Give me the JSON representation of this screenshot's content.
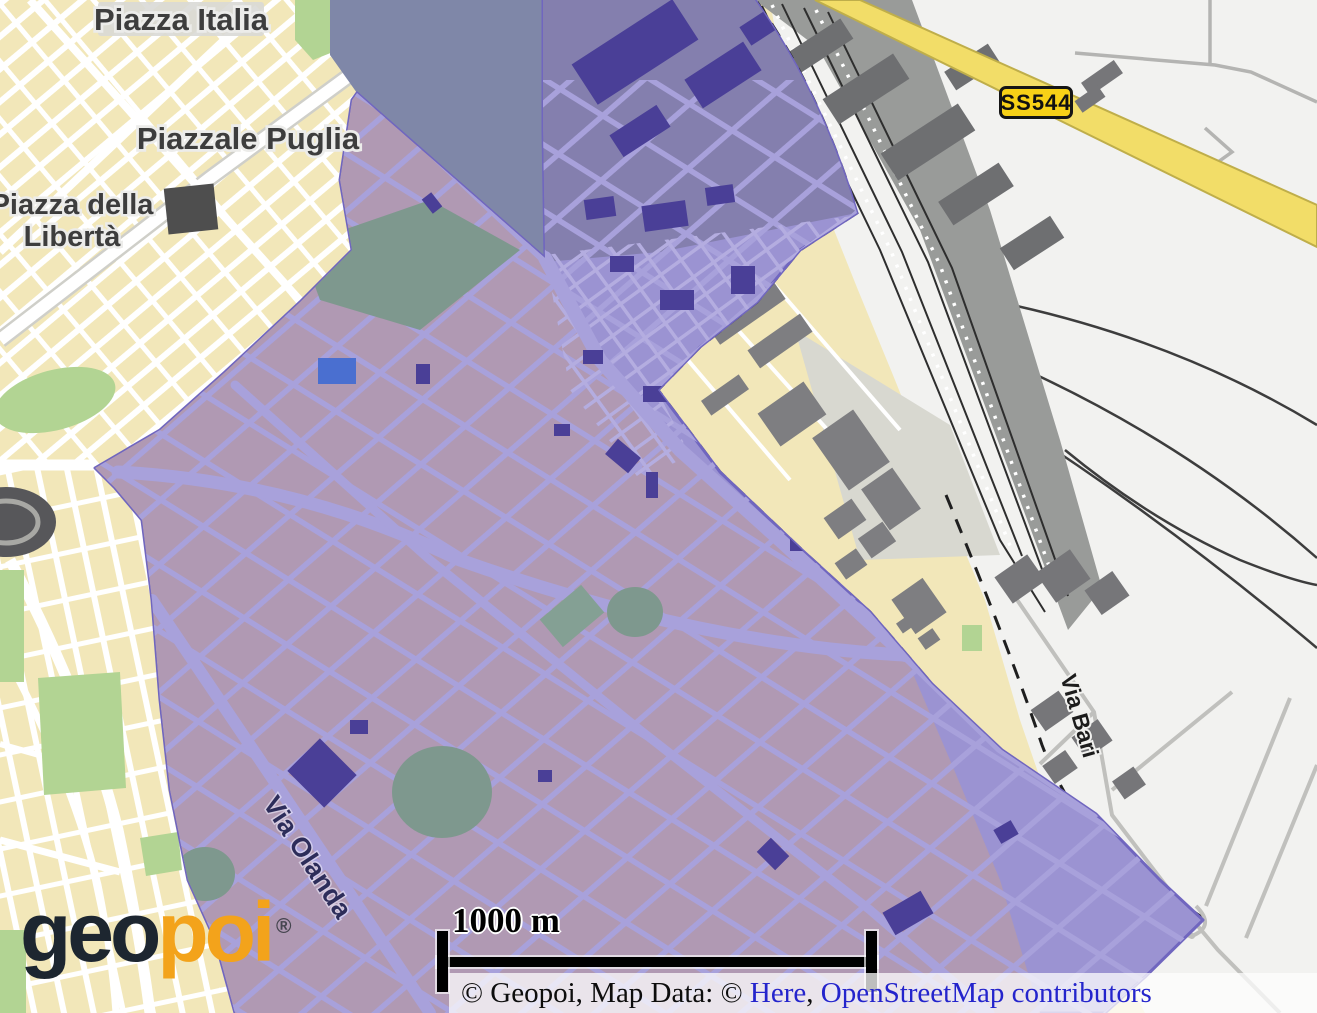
{
  "map_labels": {
    "piazza_italia": "Piazza Italia",
    "piazzale_puglia": "Piazzale Puglia",
    "piazza_della_liberta": {
      "line1": "Piazza della",
      "line2": "Libertà"
    },
    "via_olanda": "Via Olanda",
    "via_bari": "Via Bari",
    "road_shield": "SS544"
  },
  "scale_bar": {
    "label": "1000 m"
  },
  "attribution": {
    "prefix": "© Geopoi, Map Data: © ",
    "here_link": "Here",
    "separator": ", ",
    "osm_link": "OpenStreetMap contributors"
  },
  "logo": {
    "geo": "geo",
    "poi": "poi",
    "registered": "®"
  },
  "colors": {
    "land_cream": "#f2e7b9",
    "white_area": "#f2f2f0",
    "water_slate": "#7f87a8",
    "green_area": "#b2d493",
    "overlay_fill": "#9b93d2",
    "overlay_dark": "#847fae",
    "overlay_mauve": "#b099b3",
    "overlay_border": "#7066bf",
    "overlay_street": "#a8a1db",
    "building_indigo": "#4a3f97",
    "building_gray": "#7e7e81",
    "railyard_gray": "#999b99",
    "road_yellow": "#f2dd68",
    "shield_yellow": "#f7d117",
    "link_blue": "#2424cc",
    "logo_dark": "#1d2630",
    "logo_orange": "#f3a31b",
    "pond_blue": "#4a6fd0"
  }
}
